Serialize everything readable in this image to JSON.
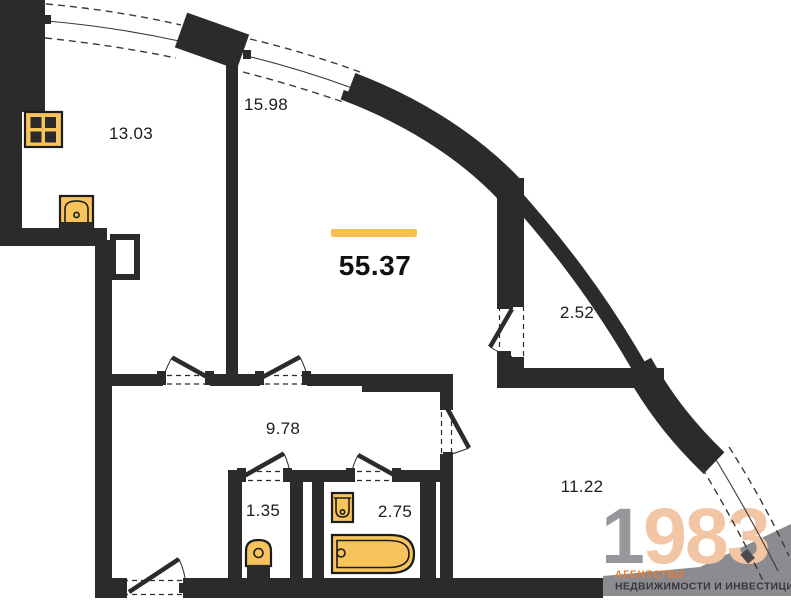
{
  "plan": {
    "total_area_label": "55.37",
    "rooms": [
      {
        "name": "kitchen",
        "area_label": "13.03"
      },
      {
        "name": "living-room",
        "area_label": "15.98"
      },
      {
        "name": "balcony",
        "area_label": "2.52"
      },
      {
        "name": "hallway",
        "area_label": "9.78"
      },
      {
        "name": "wc",
        "area_label": "1.35"
      },
      {
        "name": "bathroom",
        "area_label": "2.75"
      },
      {
        "name": "bedroom",
        "area_label": "11.22"
      }
    ]
  },
  "branding": {
    "year_digit_gray": "1",
    "year_digits_accent": "983",
    "tagline_line1": "АГЕНТСТВО",
    "tagline_line2": "НЕДВИЖИМОСТИ И ИНВЕСТИЦИЙ"
  },
  "colors": {
    "wall": "#2b2b2b",
    "fixture_fill": "#f6c45a",
    "accent_bar": "#f8bf52",
    "logo_gray": "#98989c",
    "logo_peach": "#f2c6a5",
    "tagline_orange": "#ee7c2b",
    "tagline_dark": "#38383a",
    "watermark_gray": "#8c8c90"
  },
  "fixtures": [
    "stove-icon",
    "kitchen-sink-icon",
    "toilet-icon",
    "washbasin-icon",
    "bathtub-icon"
  ]
}
